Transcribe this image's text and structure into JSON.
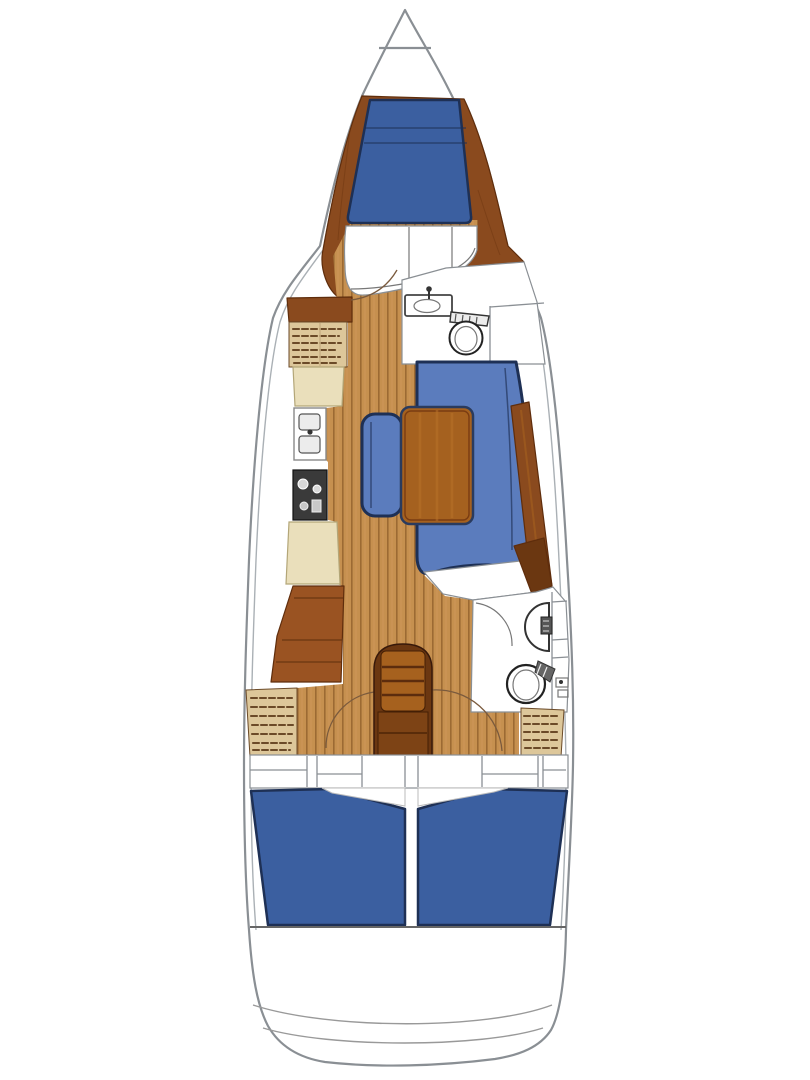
{
  "figure": {
    "type": "sailboat-interior-floor-plan",
    "view": "top-down",
    "bow_direction": "up"
  },
  "areas": {
    "anchor_locker": "anchor locker at bow",
    "forward_cabin": "forward V-berth double cabin",
    "forward_seat": "curved bench at foot of V-berth",
    "forward_head": "forward bathroom with sink and toilet",
    "port_lockers": "port shelved lockers and cabinets",
    "galley": "port-side galley with sink, stove and counters",
    "chart_table": "port chart table desk",
    "salon": "salon with U-shaped settee, wood table and bench seat",
    "sideboard": "starboard sideboard along hull",
    "aft_head": "aft bathroom with sink, toilet and shower",
    "companionway": "companionway steps over engine compartment",
    "port_aft_cabin": "port aft double berth cabin",
    "starboard_aft_cabin": "starboard aft double berth cabin",
    "transom": "stern transom with step curves"
  },
  "colors": {
    "hull_fill": "#ffffff",
    "hull_outline": "#8a8f94",
    "inner_line": "#aab0b5",
    "wood_dark": "#8a4a1e",
    "wood_mid": "#9a5322",
    "wood_grain": "#6e3510",
    "floor_base": "#c6904f",
    "floor_stripe": "#9c6a33",
    "floor_stripe_light": "#d49a5e",
    "mattress_blue": "#3b5fa0",
    "settee_blue": "#5b7cbd",
    "cushion_border": "#1e3055",
    "cream": "#eadfbb",
    "cream_border": "#b3a678",
    "locker_beige": "#ddc79a",
    "locker_stripe": "#6b4a28",
    "stove_dark": "#3a3a3a",
    "fixture_white": "#ffffff",
    "fixture_line": "#444444",
    "table_wood": "#a5611f",
    "table_border": "#2a3b5e",
    "steps_dark": "#6b3711",
    "steps_light": "#a6611e",
    "arc_line": "#7a5a3d",
    "partition": "#8a8f94",
    "transom_line": "#999999"
  }
}
